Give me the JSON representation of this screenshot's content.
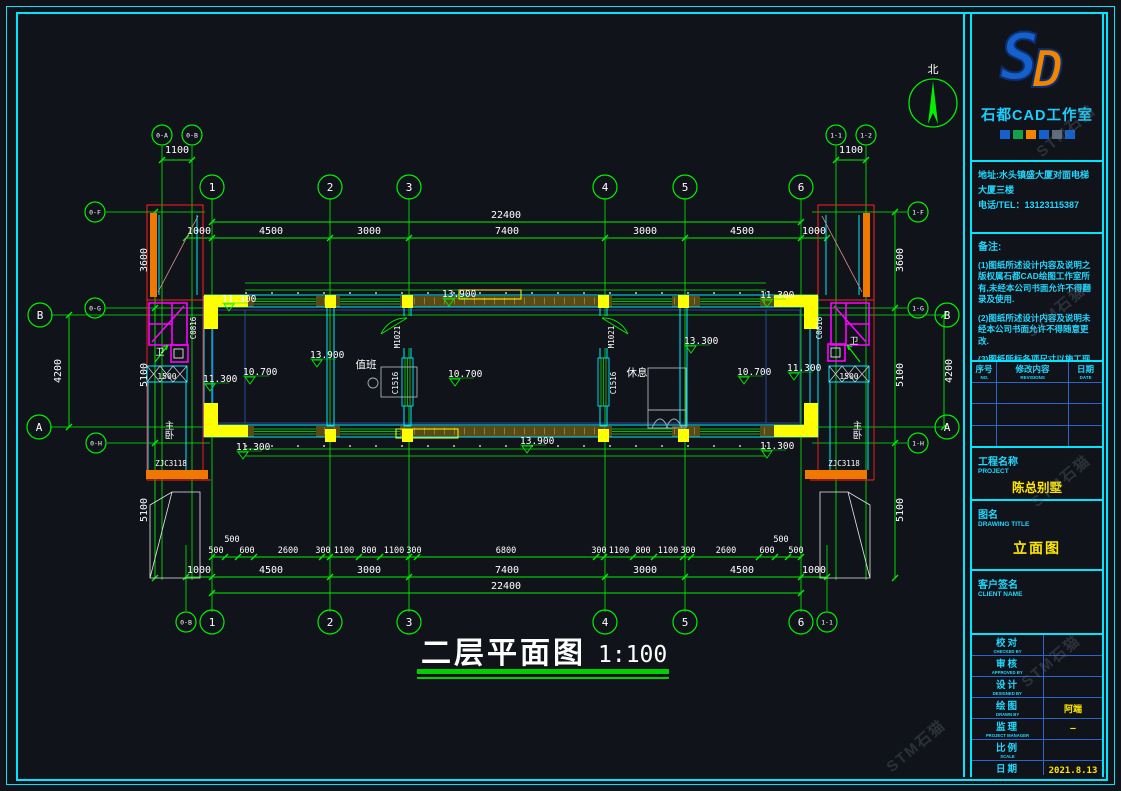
{
  "page": {
    "watermark": "STM石猫"
  },
  "north": {
    "label": "北"
  },
  "title": {
    "text": "二层平面图",
    "scale": "1:100"
  },
  "panel": {
    "logo_s": "S",
    "logo_d": "D",
    "studio": "石都CAD工作室",
    "address1": "地址:水头镇盛大厦对面电梯",
    "address2": "大厦三楼",
    "phone": "电话/TEL：13123115387",
    "notes_title": "备注:",
    "note1": "(1)图纸所述设计内容及说明之版权属石都CAD绘图工作室所有,未经本公司书面允许不得翻录及使用.",
    "note2": "(2)图纸所述设计内容及说明未经本公司书面允许不得随意更改.",
    "note3": "(3)图纸所标各项尺寸以施工现场实地尺寸为准,除注明外,所有尺寸均以毫米来表示.",
    "rev": {
      "c1": "序号",
      "c1en": "NO.",
      "c2": "修改内容",
      "c2en": "REVISIONS",
      "c3": "日期",
      "c3en": "DATE"
    },
    "project_zh": "工程名称",
    "project_en": "PROJECT",
    "project_name": "陈总别墅",
    "drawing_zh": "图名",
    "drawing_en": "DRAWING TITLE",
    "drawing_name": "立面图",
    "client_zh": "客户签名",
    "client_en": "CLIENT NAME",
    "rows": [
      {
        "zh": "校对",
        "en": "CHECKED BY",
        "val": ""
      },
      {
        "zh": "审核",
        "en": "APPROVED BY",
        "val": ""
      },
      {
        "zh": "设计",
        "en": "DESIGNED BY",
        "val": ""
      },
      {
        "zh": "绘图",
        "en": "DRAWN BY",
        "val": "阿端"
      },
      {
        "zh": "监理",
        "en": "PROJECT MANAGER",
        "val": "—"
      },
      {
        "zh": "比例",
        "en": "SCALE",
        "val": ""
      },
      {
        "zh": "日期",
        "en": "DATE",
        "val": "2021.8.13"
      },
      {
        "zh": "图号",
        "en": "DRAWING No.",
        "val": "LM-05"
      }
    ]
  },
  "plan": {
    "bubbles": {
      "cols": [
        "1",
        "2",
        "3",
        "4",
        "5",
        "6"
      ],
      "row_a": "A",
      "row_b": "B",
      "aux": {
        "lt1": "0-A",
        "lt2": "0-B",
        "rt1": "1-1",
        "rt2": "1-2",
        "lc1": "0-F",
        "lc2": "0-G",
        "lc3": "0-H",
        "rc1": "1-F",
        "rc2": "1-G",
        "rc3": "1-H",
        "bl": "0-B",
        "br": "1-1"
      }
    },
    "dims": {
      "d1100": "1100",
      "total": "22400",
      "top": [
        "1000",
        "4500",
        "3000",
        "7400",
        "3000",
        "4500",
        "1000"
      ],
      "detail": [
        "500",
        "500",
        "600",
        "2600",
        "300",
        "1100",
        "800",
        "1100",
        "300",
        "6800",
        "300",
        "1100",
        "800",
        "1100",
        "300",
        "2600",
        "600",
        "500",
        "500"
      ],
      "left": [
        "3600",
        "5100",
        "5100"
      ],
      "ab": "4200",
      "stair": "1500"
    },
    "elev": {
      "e113": "11.300",
      "e107": "10.700",
      "e139": "13.900",
      "e133": "13.300"
    },
    "rooms": {
      "duty": "值班",
      "rest": "休息",
      "master": "主卧",
      "wc": "卫"
    },
    "codes": {
      "door": "M1021",
      "win": "C1516",
      "win2": "C0816",
      "zj": "ZJC3118"
    }
  }
}
